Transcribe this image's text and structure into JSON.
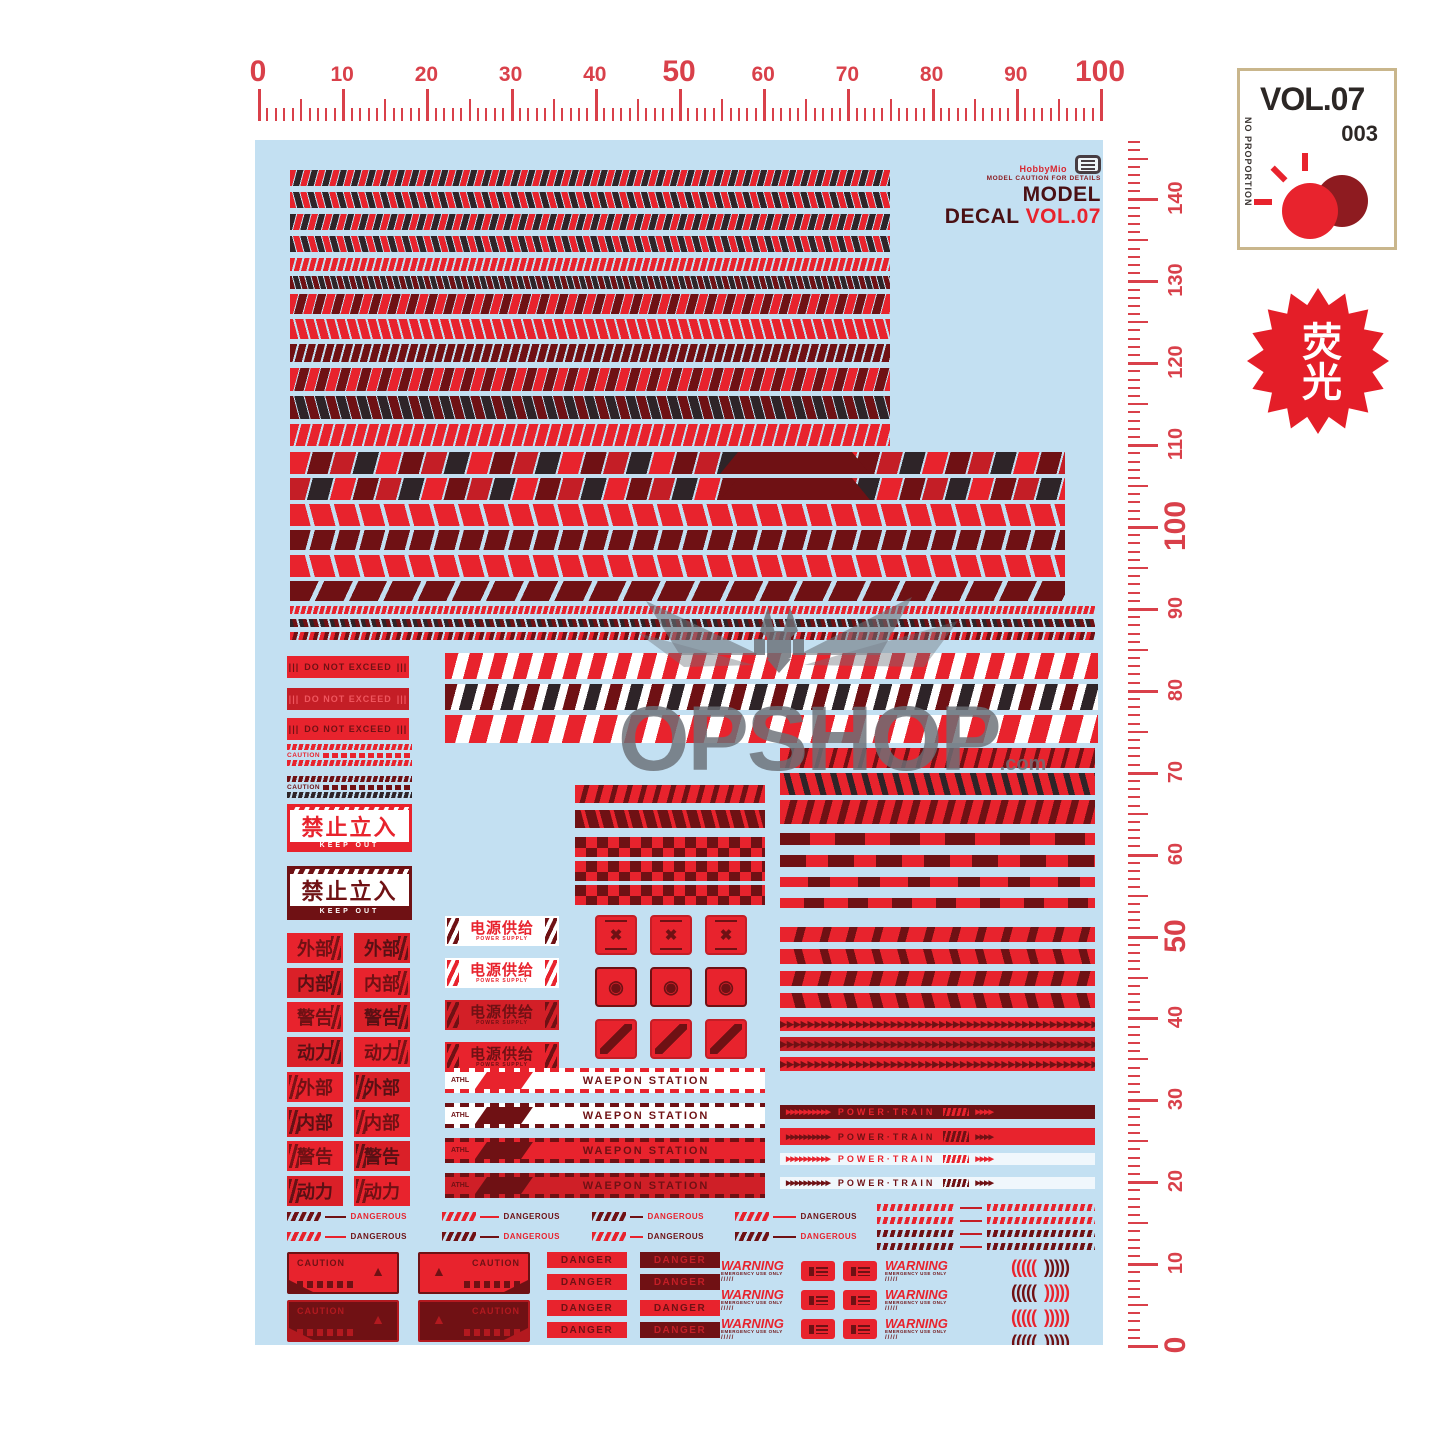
{
  "colors": {
    "sheet": "#c3e0f2",
    "red": "#e8232d",
    "red_deep": "#c41e26",
    "maroon": "#6f1114",
    "dark": "#2e2428",
    "ruler": "#d9404a",
    "white": "#ffffff",
    "badge_border": "#c9b68c",
    "watermark": "#6b7077"
  },
  "ruler_top": {
    "labels": [
      "0",
      "10",
      "20",
      "30",
      "40",
      "50",
      "60",
      "70",
      "80",
      "90",
      "100"
    ]
  },
  "ruler_right": {
    "labels": [
      "0",
      "10",
      "20",
      "30",
      "40",
      "50",
      "60",
      "70",
      "80",
      "90",
      "100",
      "110",
      "120",
      "130",
      "140"
    ]
  },
  "badge": {
    "vol": "VOL.07",
    "number": "003",
    "side_text": "NO PROPORTION"
  },
  "fluorescent_badge": {
    "text": "荧光"
  },
  "logo": {
    "brand": "HobbyMio",
    "caption": "MODEL CAUTION FOR DETAILS",
    "title": "MODEL DECAL",
    "vol": "VOL.07"
  },
  "watermark": {
    "text": "OPSHOP",
    "suffix": ".com"
  },
  "decals": {
    "do_not_exceed": {
      "bars": "|||",
      "text": "DO NOT EXCEED"
    },
    "caution_tape": {
      "text": "CAUTION"
    },
    "keep_out": {
      "cn": "禁止立入",
      "en": "KEEP OUT"
    },
    "grid_labels": [
      "外部",
      "内部",
      "警告",
      "动力"
    ],
    "power_supply": {
      "cn": "电源供给",
      "en": "POWER SUPPLY"
    },
    "weapon_station": {
      "prefix": "ATHL",
      "text": "WAEPON STATION"
    },
    "dangerous": {
      "text": "DANGEROUS"
    },
    "power_train": {
      "arrows": "▶▶▶▶▶▶▶▶▶▶",
      "arrows_short": "▶▶▶▶",
      "text": "POWER·TRAIN"
    },
    "caution_box": {
      "text": "CAUTION"
    },
    "danger": {
      "text": "DANGER"
    },
    "warning": {
      "text": "WARNING",
      "sub": "EMERGENCY USE ONLY",
      "marks": "/////"
    },
    "brackets": {
      "left": "(((((",
      "right": ")))))"
    }
  }
}
